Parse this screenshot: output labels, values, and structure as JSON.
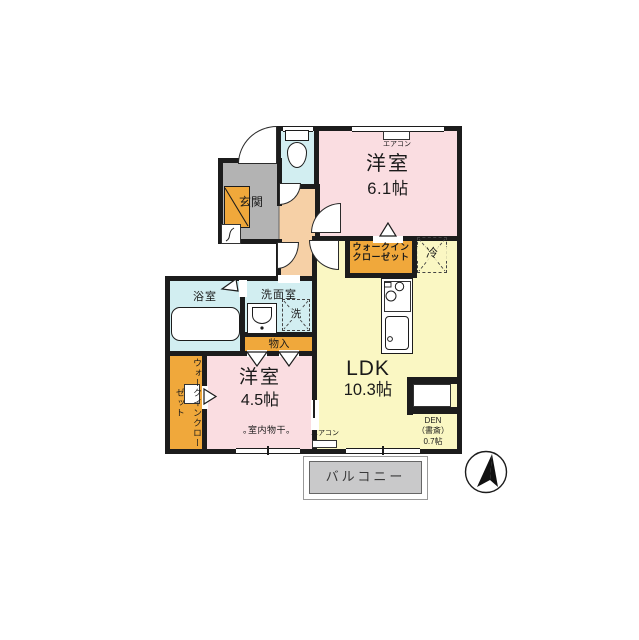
{
  "title": "2LDK floor plan",
  "rooms": {
    "bedroom_top": {
      "name": "洋室",
      "size": "6.1帖"
    },
    "bedroom_bottom": {
      "name": "洋室",
      "size": "4.5帖"
    },
    "ldk": {
      "name": "LDK",
      "size": "10.3帖"
    },
    "den": {
      "name": "DEN",
      "alias": "（書斎）",
      "size": "0.7帖"
    },
    "entrance": {
      "label": "玄関"
    },
    "bath": {
      "label": "浴室"
    },
    "washroom": {
      "label": "洗面室"
    },
    "laundry_space": {
      "label": "洗"
    },
    "storage": {
      "label": "物入"
    },
    "walkin_closet_top": {
      "line1": "ウォークイン",
      "line2": "クローゼット"
    },
    "walkin_closet_left": {
      "line1": "ウォークイン",
      "line2": "クローゼット"
    },
    "refrigerator_space": {
      "label": "冷"
    },
    "balcony": {
      "label": "バルコニー"
    }
  },
  "annotations": {
    "aircon_top": "エアコン",
    "aircon_bottom": "エアコン",
    "indoor_drying": "｡室内物干｡"
  },
  "colors": {
    "wall": "#1c1c1c",
    "bedroom_fill": "#fadde1",
    "ldk_fill": "#faf7c3",
    "wet_area_fill": "#d2eef1",
    "hall_fill": "#f6d0a6",
    "entrance_fill": "#b3b3b3",
    "closet_fill": "#f0a83b",
    "balcony_fill": "#c9c9ca"
  }
}
